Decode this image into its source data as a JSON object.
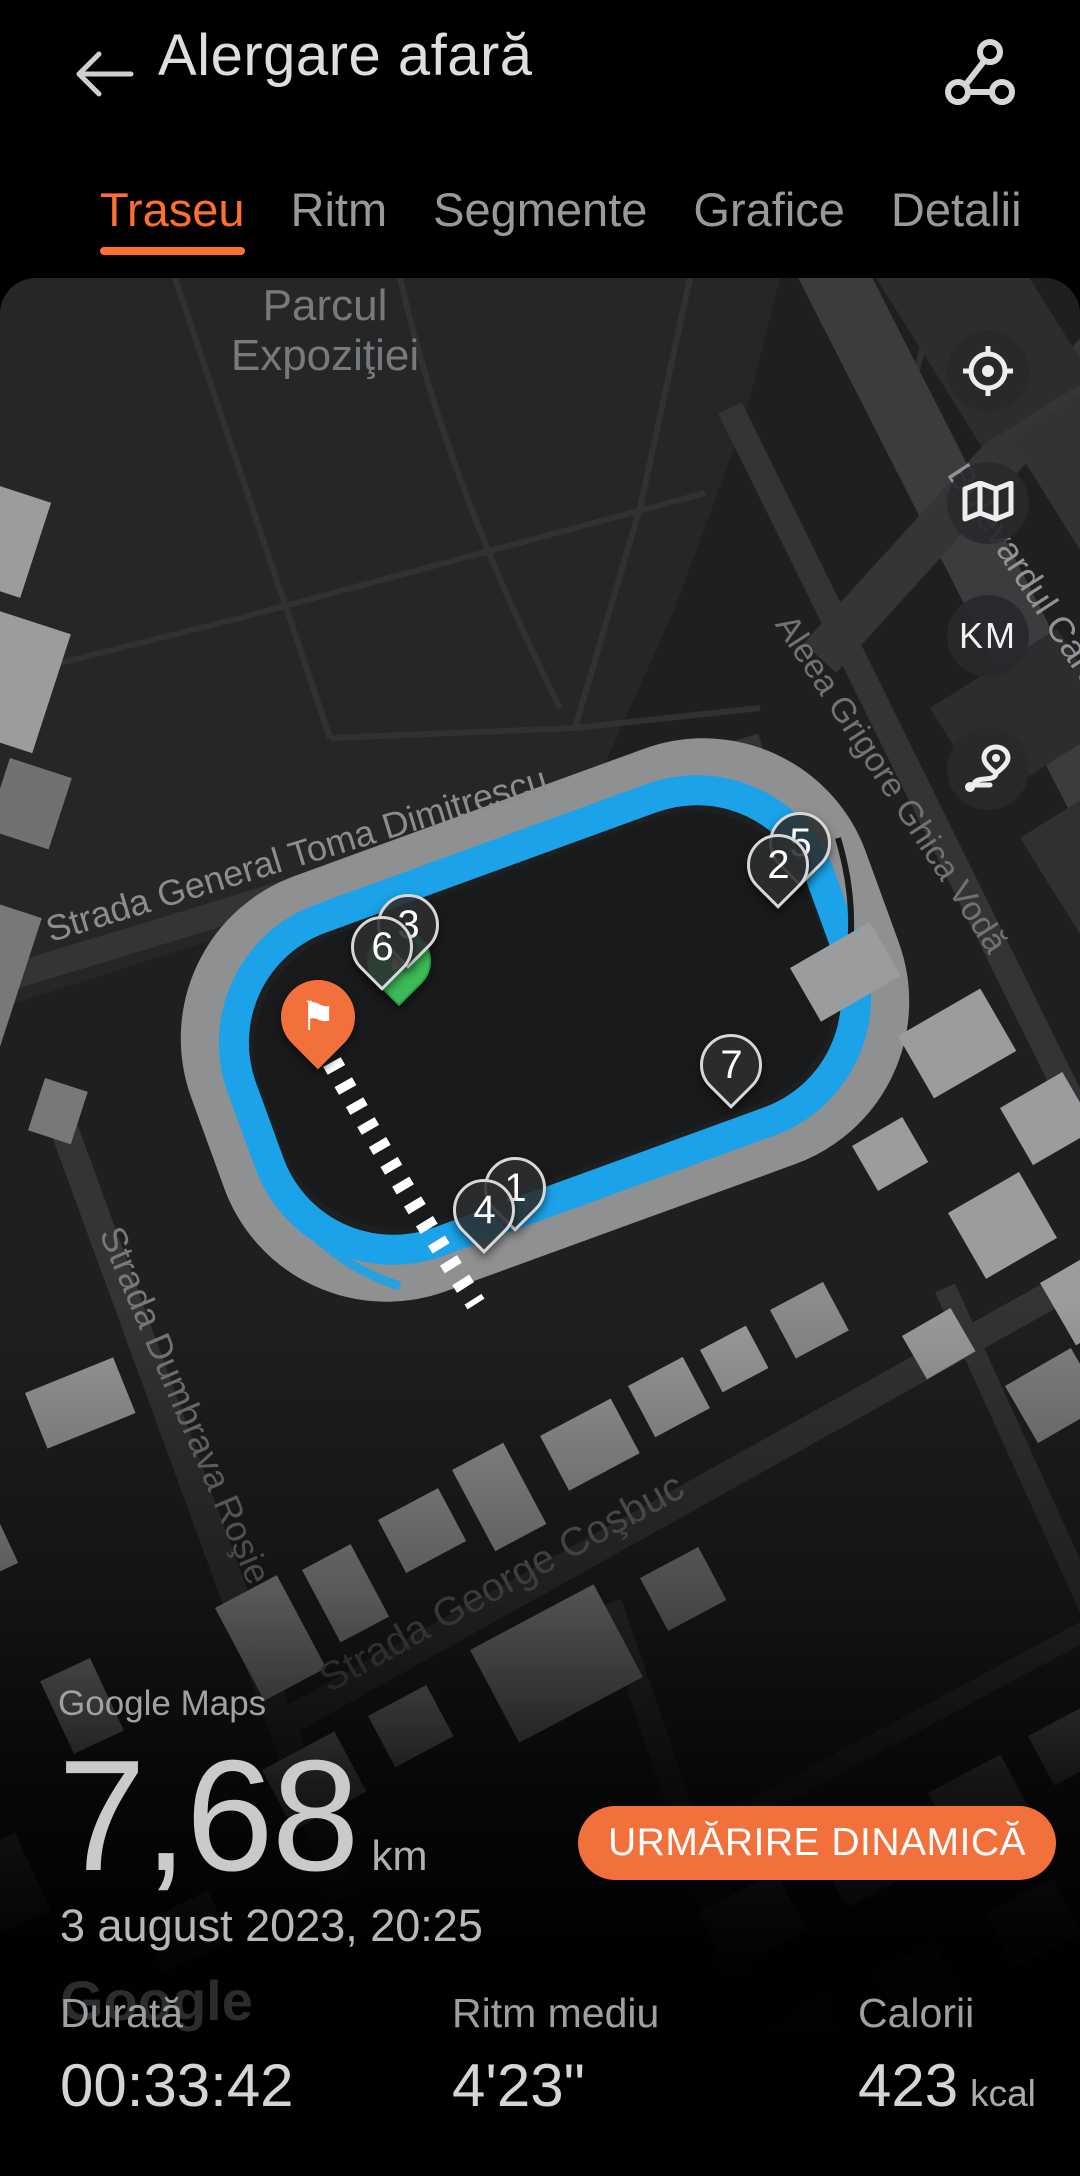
{
  "header": {
    "title": "Alergare afară"
  },
  "tabs": [
    {
      "label": "Traseu"
    },
    {
      "label": "Ritm"
    },
    {
      "label": "Segmente"
    },
    {
      "label": "Grafice"
    },
    {
      "label": "Detalii"
    }
  ],
  "map": {
    "labels": {
      "park_line1": "Parcul",
      "park_line2": "Expoziţiei",
      "street_dimitrescu": "Strada General Toma Dimitrescu",
      "street_ghica": "Aleea Grigore Ghica Vodă",
      "street_carol": "Bulevardul Carol I",
      "street_dumbrava": "Strada Dumbrava Roşie",
      "street_cosbuc": "Strada George Coşbuc"
    },
    "controls": {
      "km_label": "KM"
    },
    "markers": [
      "2",
      "5",
      "3",
      "6",
      "7",
      "1",
      "4"
    ],
    "finish_flag_icon": "⚑",
    "attribution": "Google Maps",
    "google_watermark": "Google"
  },
  "summary": {
    "distance_value": "7,68",
    "distance_unit": "km",
    "tracking_button": "URMĂRIRE DINAMICĂ",
    "date": "3 august 2023, 20:25"
  },
  "stats": [
    {
      "label": "Durată",
      "value": "00:33:42",
      "unit": ""
    },
    {
      "label": "Ritm mediu",
      "value": "4'23\"",
      "unit": ""
    },
    {
      "label": "Calorii",
      "value": "423",
      "unit": "kcal"
    }
  ],
  "colors": {
    "accent_tab": "#FF6F2E",
    "button_orange": "#F2703C",
    "route_blue": "#1BA2E8",
    "track_gray": "#8F9092",
    "start_green": "#3DBB58"
  }
}
